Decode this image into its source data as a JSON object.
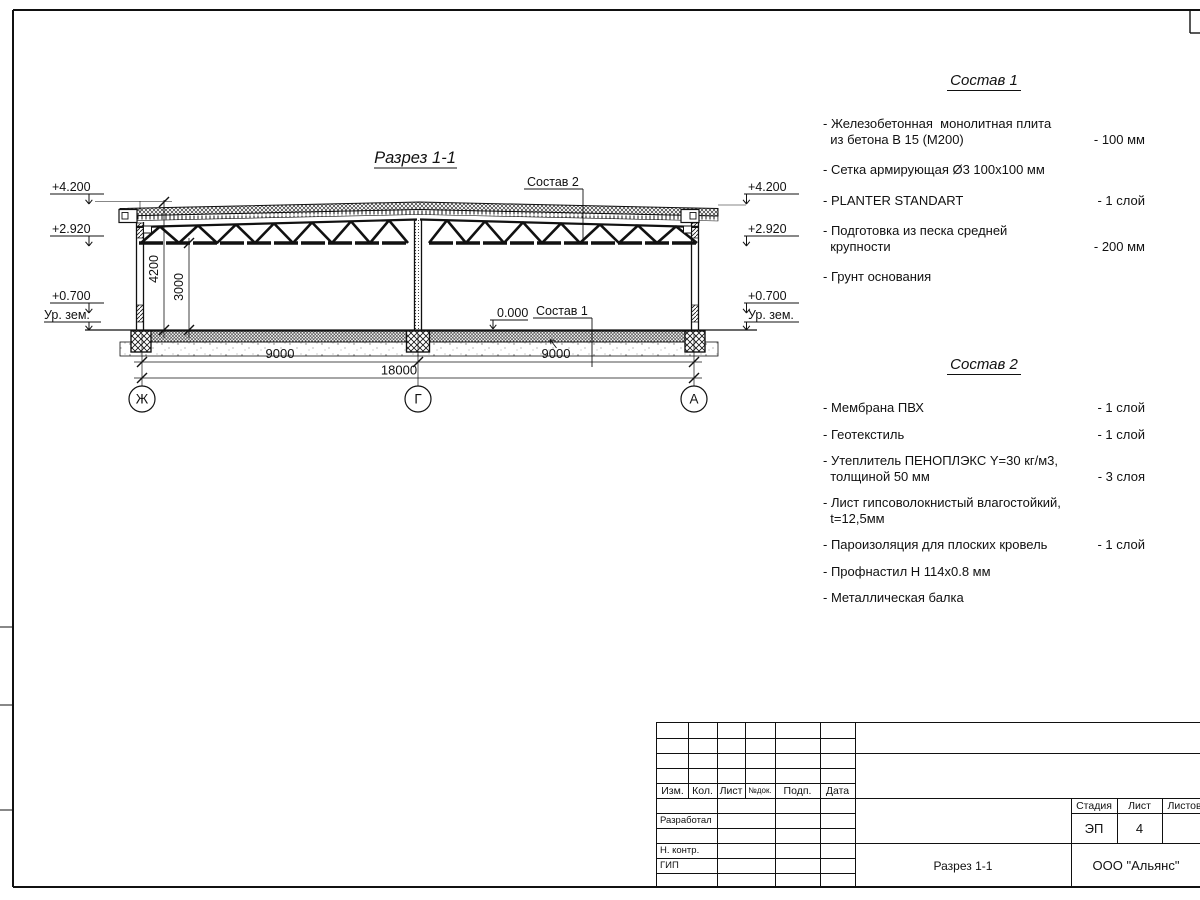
{
  "drawing": {
    "title": "Разрез 1-1",
    "labels": {
      "sostav2_ref": "Состав 2",
      "sostav1_ref": "Состав 1",
      "zero": "0.000"
    },
    "elevations": {
      "left": [
        "+4.200",
        "+2.920",
        "+0.700",
        "Ур. зем."
      ],
      "right": [
        "+4.200",
        "+2.920",
        "+0.700",
        "Ур. зем."
      ]
    },
    "dims": {
      "v_total": "4200",
      "v_clear": "3000",
      "span_left": "9000",
      "span_right": "9000",
      "total": "18000"
    },
    "axes": {
      "left": "Ж",
      "center": "Г",
      "right": "А"
    }
  },
  "compositions": [
    {
      "title": "Состав 1",
      "items": [
        {
          "text": "- Железобетонная  монолитная плита\n  из бетона В 15 (М200)",
          "value": "- 100 мм"
        },
        {
          "text": "- Сетка армирующая Ø3 100х100 мм",
          "value": ""
        },
        {
          "text": "- PLANTER STANDART",
          "value": "-  1 слой"
        },
        {
          "text": "- Подготовка из песка средней\n  крупности",
          "value": "- 200 мм"
        },
        {
          "text": "- Грунт основания",
          "value": ""
        }
      ]
    },
    {
      "title": "Состав 2",
      "items": [
        {
          "text": "- Мембрана ПВХ",
          "value": "- 1 слой"
        },
        {
          "text": "- Геотекстиль",
          "value": "- 1 слой"
        },
        {
          "text": "- Утеплитель ПЕНОПЛЭКС Y=30 кг/м3,\n  толщиной 50 мм",
          "value": "- 3 слоя"
        },
        {
          "text": "- Лист гипсоволокнистый влагостойкий,\n  t=12,5мм",
          "value": ""
        },
        {
          "text": "- Пароизоляция для плоских кровель",
          "value": "- 1 слой"
        },
        {
          "text": "- Профнастил Н 114х0.8 мм",
          "value": ""
        },
        {
          "text": "- Металлическая балка",
          "value": ""
        }
      ]
    }
  ],
  "title_block": {
    "change_cols": [
      "Изм.",
      "Кол.",
      "Лист",
      "№док.",
      "Подп.",
      "Дата"
    ],
    "signature_rows": [
      "Разработал",
      "Н. контр.",
      "ГИП"
    ],
    "stage_label": "Стадия",
    "sheet_label": "Лист",
    "sheets_label": "Листов",
    "stage_value": "ЭП",
    "sheet_value": "4",
    "doc_name": "Разрез 1-1",
    "company": "ООО \"Альянс\""
  }
}
